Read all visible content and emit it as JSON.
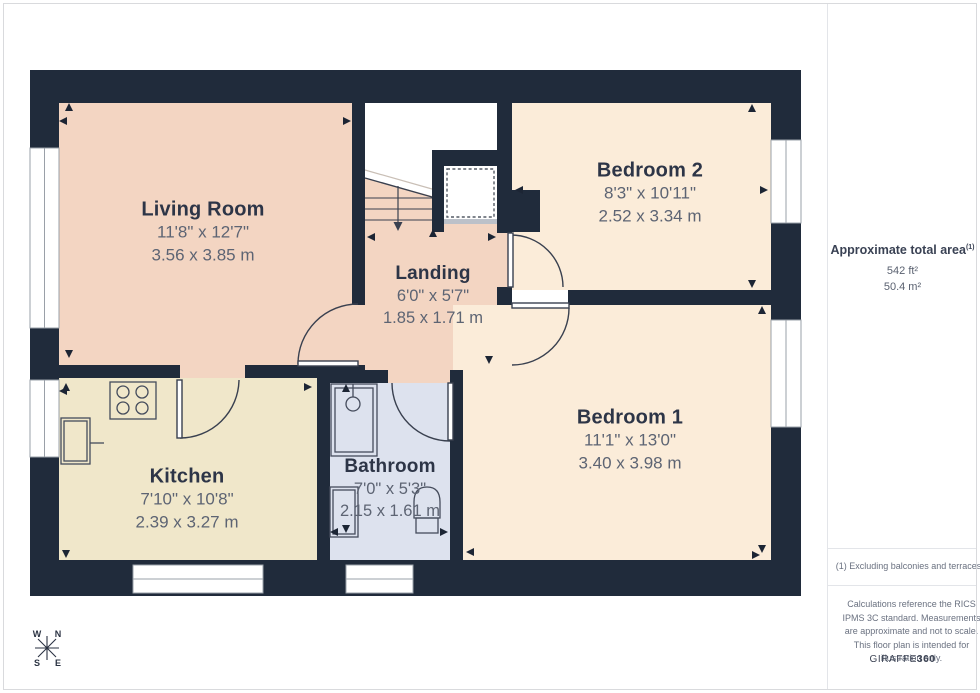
{
  "plan": {
    "rooms": [
      {
        "id": "living-room",
        "name": "Living Room",
        "imperial": "11'8\" x 12'7\"",
        "metric": "3.56 x 3.85 m"
      },
      {
        "id": "landing",
        "name": "Landing",
        "imperial": "6'0\" x 5'7\"",
        "metric": "1.85 x 1.71 m"
      },
      {
        "id": "bedroom-2",
        "name": "Bedroom 2",
        "imperial": "8'3\" x 10'11\"",
        "metric": "2.52 x 3.34 m"
      },
      {
        "id": "bedroom-1",
        "name": "Bedroom 1",
        "imperial": "11'1\" x 13'0\"",
        "metric": "3.40 x 3.98 m"
      },
      {
        "id": "kitchen",
        "name": "Kitchen",
        "imperial": "7'10\" x 10'8\"",
        "metric": "2.39 x 3.27 m"
      },
      {
        "id": "bathroom",
        "name": "Bathroom",
        "imperial": "7'0\" x 5'3\"",
        "metric": "2.15 x 1.61 m"
      }
    ],
    "compass": {
      "n": "N",
      "e": "E",
      "s": "S",
      "w": "W"
    }
  },
  "sidebar": {
    "area_title": "Approximate total area",
    "area_footnote_marker": "(1)",
    "area_ft": "542 ft²",
    "area_m": "50.4 m²",
    "footnote": "(1) Excluding balconies and terraces",
    "disclaimer": "Calculations reference the RICS IPMS 3C standard. Measurements are approximate and not to scale. This floor plan is intended for illustration only.",
    "brand_name": "GIRAFFE",
    "brand_suffix": "360"
  },
  "colors": {
    "wall": "#202b3b",
    "living_landing_fill": "#f3d5c2",
    "bedroom_fill": "#fbecd9",
    "kitchen_fill": "#f0e7ca",
    "bathroom_fill": "#dde2ee"
  }
}
